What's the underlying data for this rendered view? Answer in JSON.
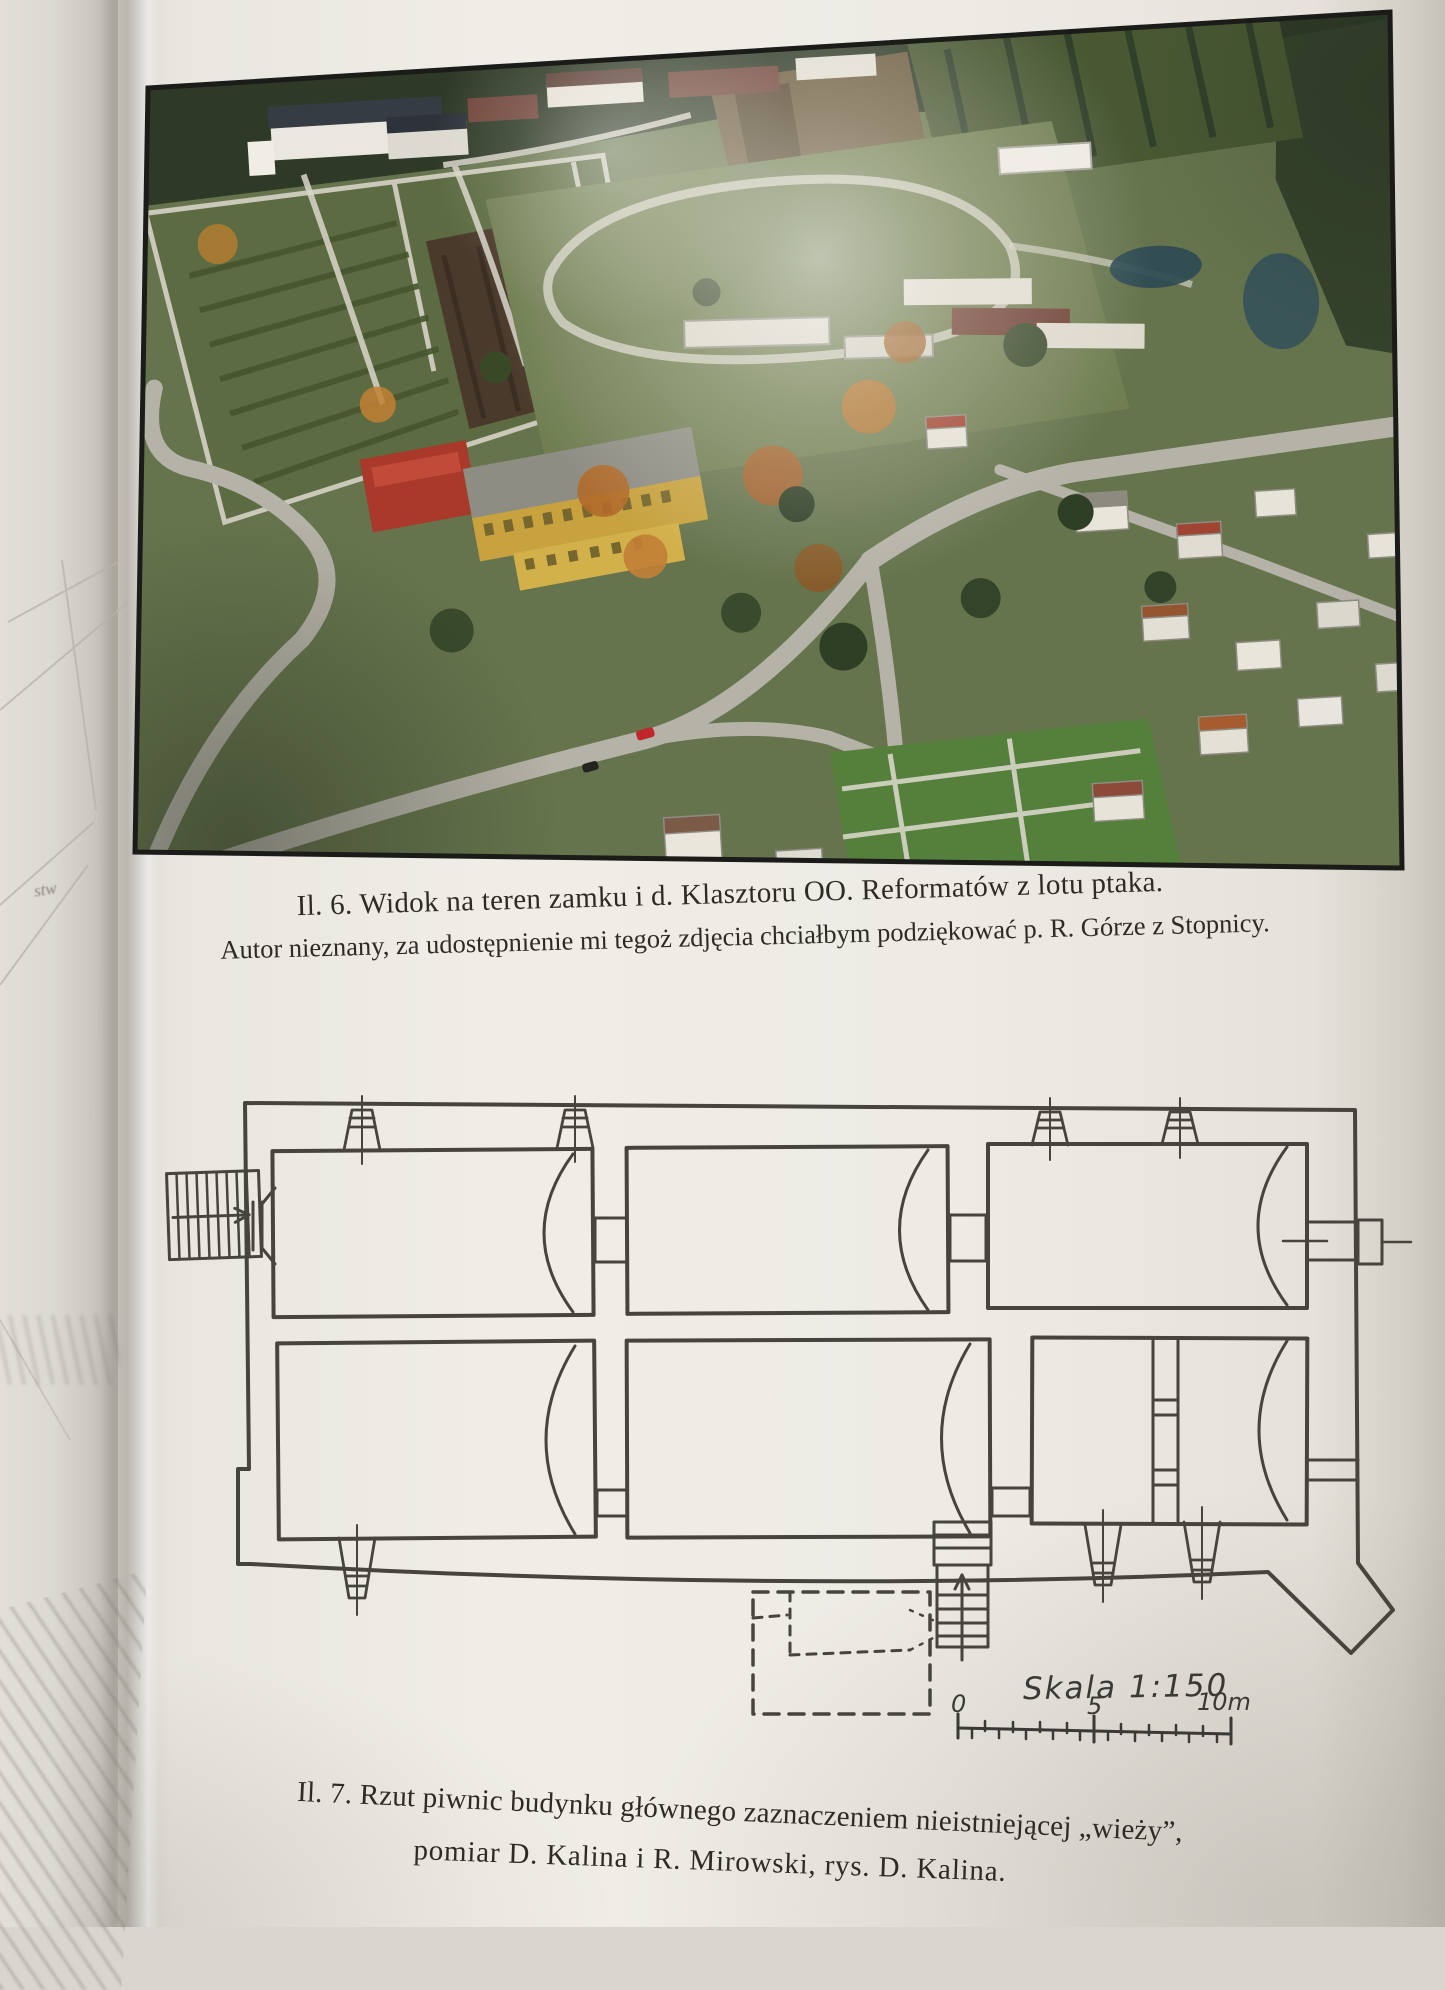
{
  "figure6": {
    "caption_line1": "Il. 6. Widok na teren zamku i d. Klasztoru OO. Reformatów z lotu ptaka.",
    "caption_line2": "Autor nieznany, za udostępnienie mi tegoż zdjęcia chciałbym podziękować p. R. Górze z Stopnicy."
  },
  "figure7": {
    "caption_line1": "Il. 7. Rzut piwnic budynku głównego  zaznaczeniem nieistniejącej „wieży”,",
    "caption_line2": "pomiar D. Kalina i R. Mirowski, rys. D. Kalina.",
    "scale": {
      "label": "Skala 1:150",
      "tick_0": "0",
      "tick_5": "5",
      "tick_10": "10m"
    }
  },
  "left_page": {
    "fragment_text": "stw"
  },
  "colors": {
    "page": "#eeebe5",
    "ink": "#2e2a25",
    "plan_ink": "#47443e",
    "photo_border": "#1b1b19",
    "handwriting": "#3b3935",
    "photo_greens": "#66744d",
    "school_yellow": "#c7a23f",
    "roof_red": "#a8392b",
    "car_red": "#c0272d"
  }
}
